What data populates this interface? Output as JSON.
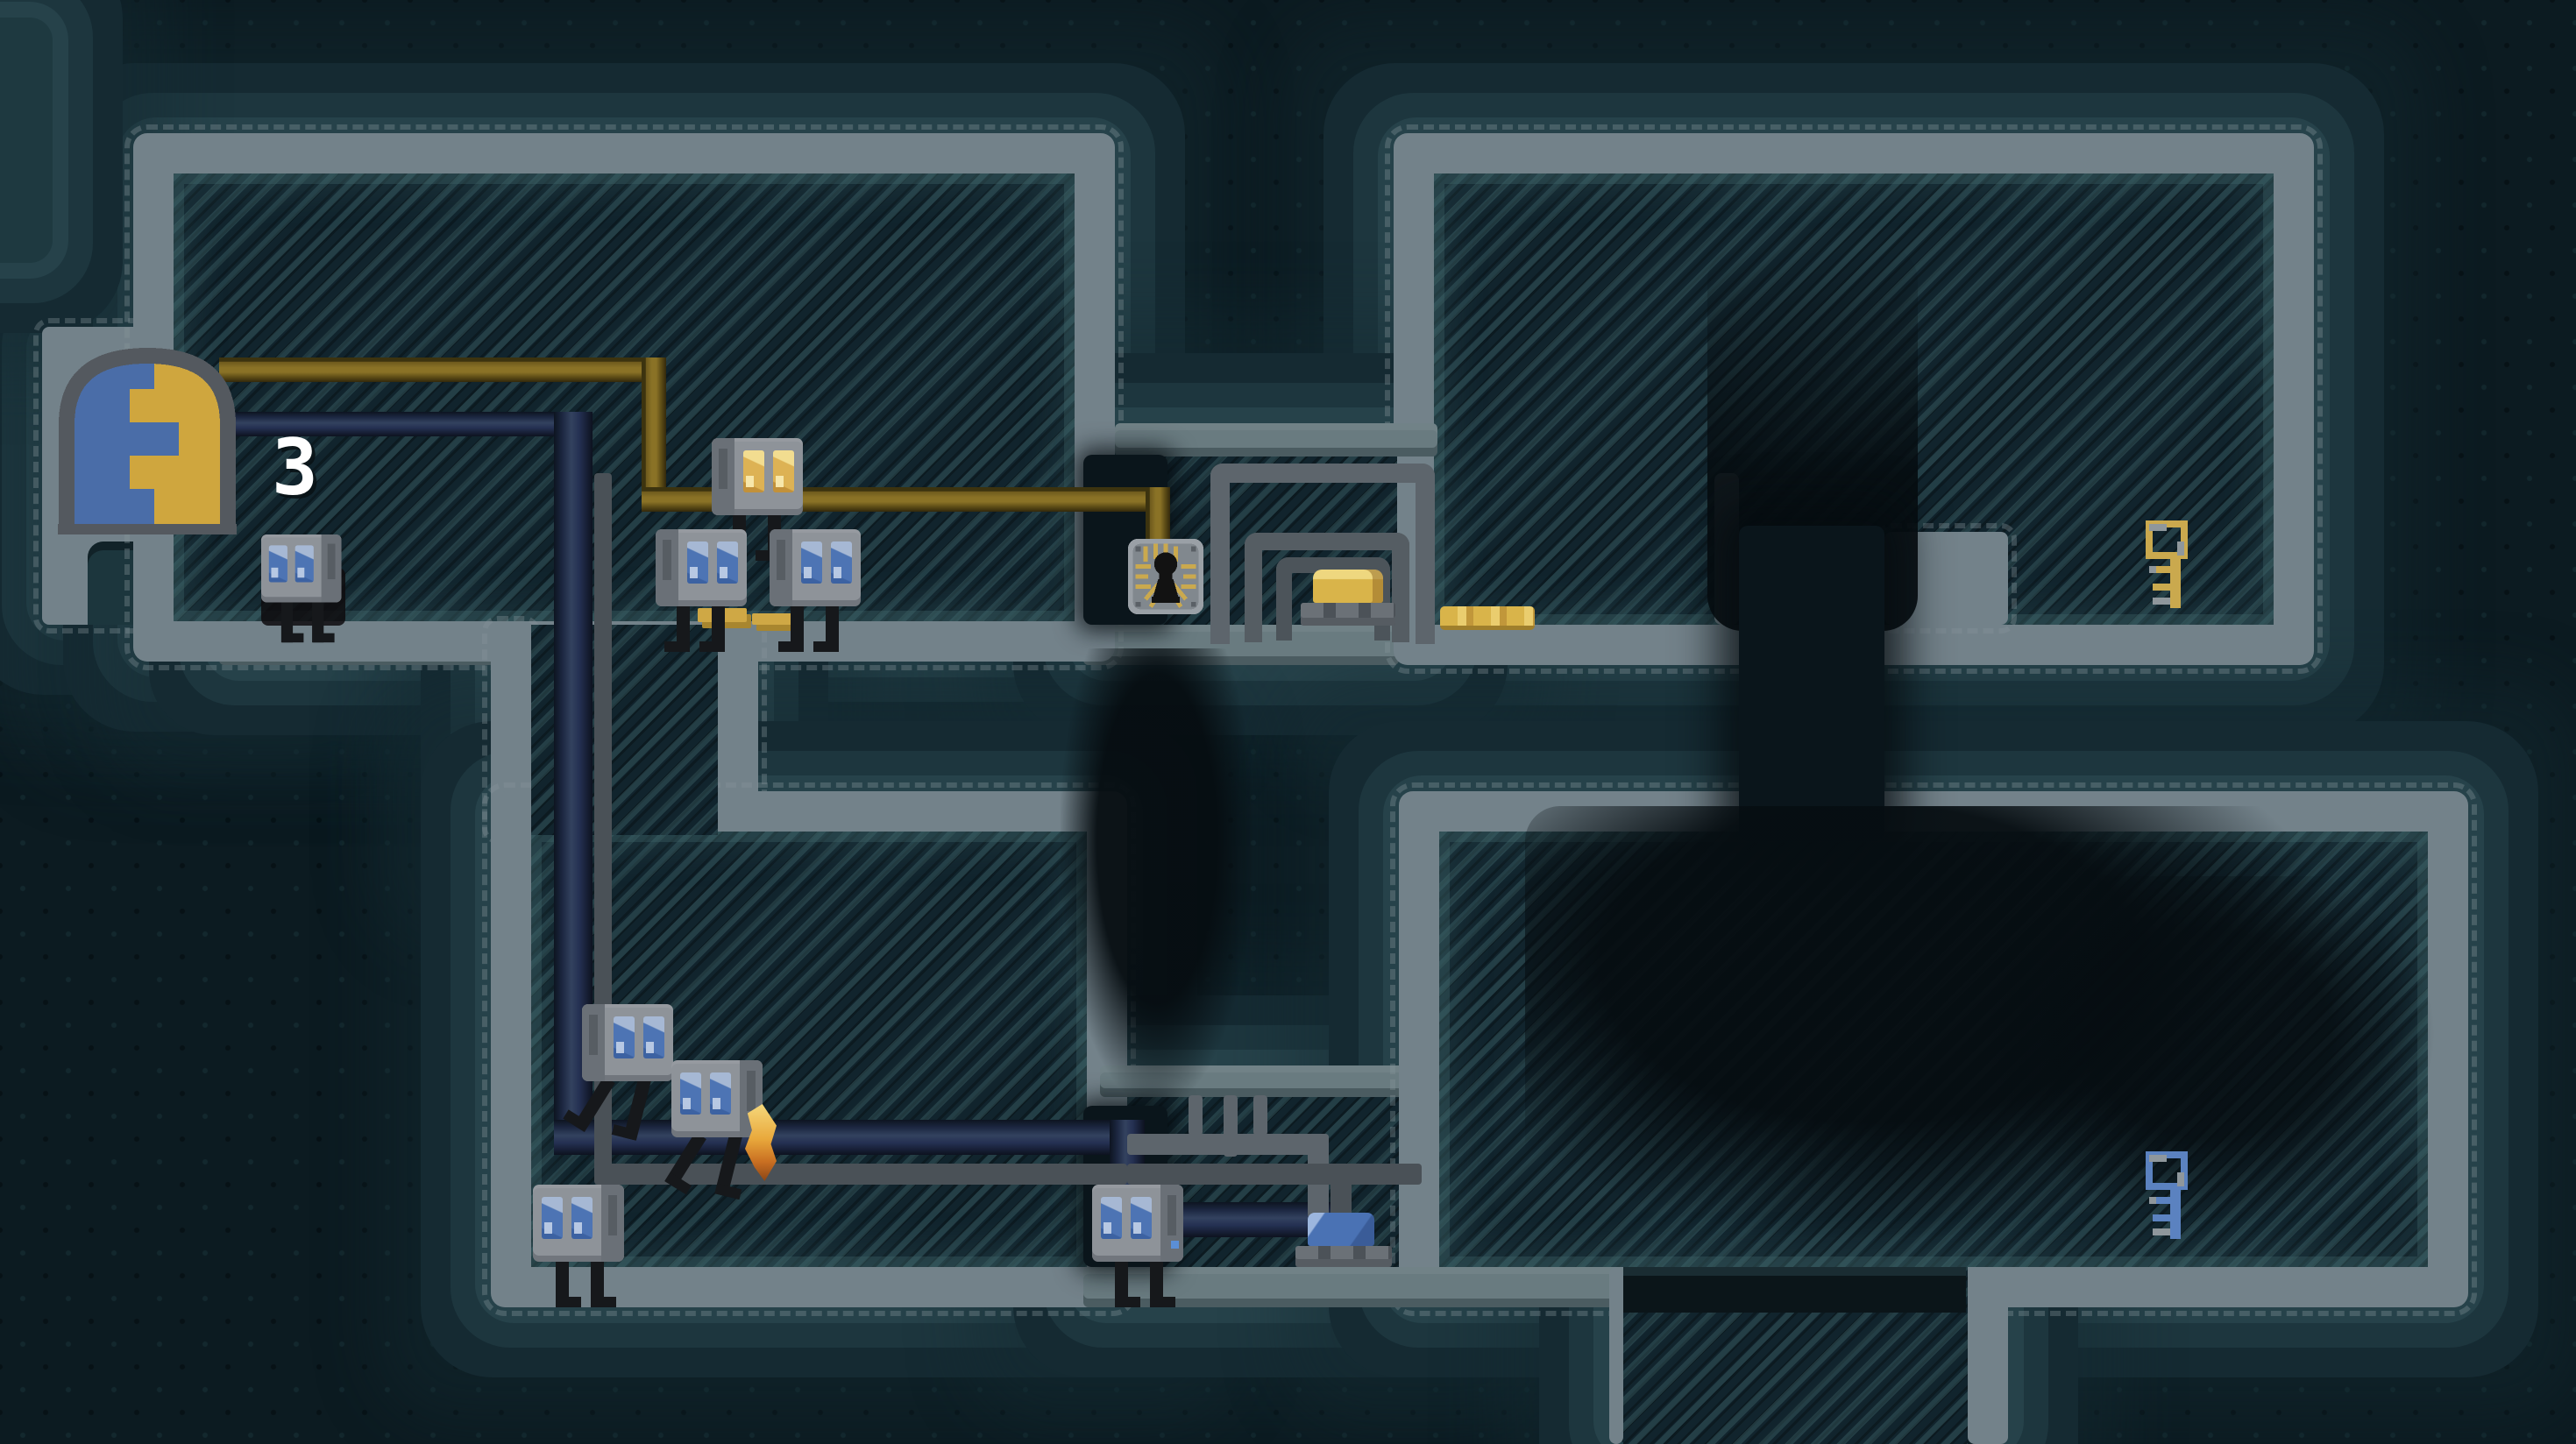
{
  "door": {
    "badge": "3",
    "name": "exit-door",
    "colors": {
      "left_panel": "#4a6da8",
      "right_panel": "#cfa63e",
      "frame": "#54595f"
    }
  },
  "robots": [
    {
      "name": "robot-gold-eyes-on-wire",
      "eye_color": "#ddb254"
    },
    {
      "name": "robot-pair-left",
      "eye_color": "#4d74b4"
    },
    {
      "name": "robot-pair-right",
      "eye_color": "#4d74b4"
    },
    {
      "name": "robot-by-door",
      "eye_color": "#4d74b4"
    },
    {
      "name": "robot-jumping-upper",
      "eye_color": "#4d74b4"
    },
    {
      "name": "robot-jumping-with-flame",
      "eye_color": "#4d74b4"
    },
    {
      "name": "robot-lower-left",
      "eye_color": "#4d74b4"
    },
    {
      "name": "robot-lower-corridor",
      "eye_color": "#4d74b4"
    }
  ],
  "items": [
    {
      "name": "gold-key",
      "color": "#caa94e"
    },
    {
      "name": "blue-key",
      "color": "#5b82c0"
    },
    {
      "name": "gold-ingot",
      "color": "#d9b44a"
    },
    {
      "name": "gold-coin",
      "color": "#d9b44a"
    },
    {
      "name": "blue-ingot",
      "color": "#4a72b4"
    },
    {
      "name": "gold-debris",
      "color": "#cfa845"
    },
    {
      "name": "circuit-spider-chip",
      "color": "#121212"
    }
  ],
  "wires": [
    {
      "name": "gold-wire",
      "color": "#8a7226"
    },
    {
      "name": "blue-wire",
      "color": "#243052"
    },
    {
      "name": "gray-pipe",
      "color": "#5d656c"
    }
  ],
  "palette": {
    "background": "#0c1b21",
    "room_hatch": "#11242d",
    "wall": "#73828a",
    "floor": "#697b80",
    "rock_glow": "#26424a",
    "dark_shaft": "#0a151b"
  }
}
